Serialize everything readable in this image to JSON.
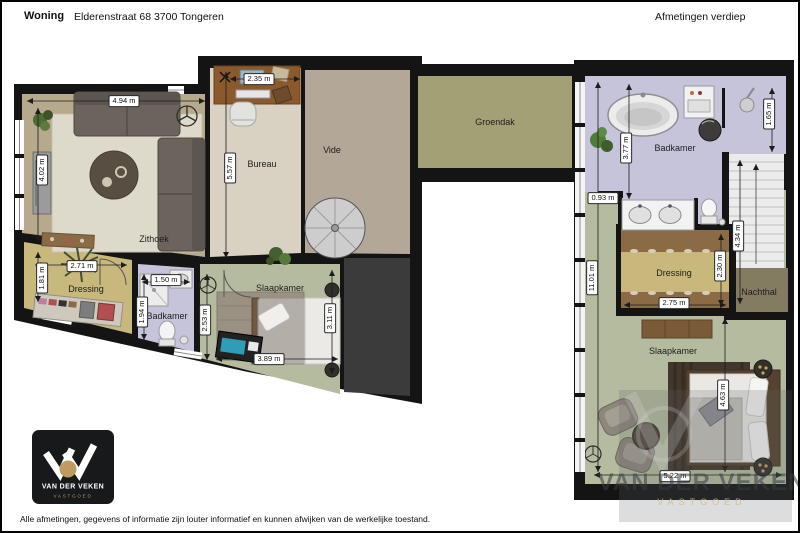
{
  "header": {
    "type_label": "Woning",
    "address": "Elderenstraat 68  3700 Tongeren",
    "plan_title": "Afmetingen verdiep"
  },
  "left_plan": {
    "rooms": {
      "zithoek": "Zithoek",
      "bureau": "Bureau",
      "vide": "Vide",
      "groendak": "Groendak",
      "dressing": "Dressing",
      "badkamer": "Badkamer",
      "slaapkamer": "Slaapkamer"
    },
    "dims": {
      "zithoek_w": "4.94 m",
      "zithoek_h": "4.02 m",
      "bureau_w": "2.35 m",
      "bureau_h": "5.57 m",
      "dressing_w": "2.71 m",
      "dressing_h": "1.81 m",
      "badkamer_w": "1.50 m",
      "badkamer_h": "1.94 m",
      "slaapkamer_left_h": "2.53 m",
      "slaapkamer_w": "3.89 m",
      "slaapkamer_h": "3.11 m"
    }
  },
  "right_plan": {
    "rooms": {
      "badkamer": "Badkamer",
      "dressing": "Dressing",
      "nachthal": "Nachthal",
      "slaapkamer": "Slaapkamer"
    },
    "dims": {
      "badkamer_h": "3.77 m",
      "badkamer_right_h": "1.65 m",
      "corridor_w": "0.93 m",
      "total_h": "11.01 m",
      "stairs_l": "4.34 m",
      "dressing_h": "2.30 m",
      "dressing_w": "2.75 m",
      "bed_zone_h": "4.63 m",
      "slaapkamer_w": "5.22 m"
    }
  },
  "logo": {
    "name": "VAN DER VEKEN",
    "subtitle": "VASTGOED"
  },
  "watermark": {
    "name": "VAN DER VEKEN",
    "subtitle": "VASTGOED"
  },
  "footer": {
    "disclaimer": "Alle afmetingen, gegevens of informatie zijn louter informatief en kunnen afwijken van de werkelijke toestand."
  },
  "colors": {
    "wall": "#141414",
    "floor_tan": "#b7a98c",
    "floor_cream": "#d9d2c3",
    "floor_taupe": "#b3a797",
    "roof_green": "#a3a076",
    "floor_khaki": "#c9b87b",
    "floor_lilac": "#c6c4da",
    "floor_sage": "#b4bb9e",
    "nachthal_olive": "#847c60",
    "logo_gold": "#c09a5e"
  }
}
